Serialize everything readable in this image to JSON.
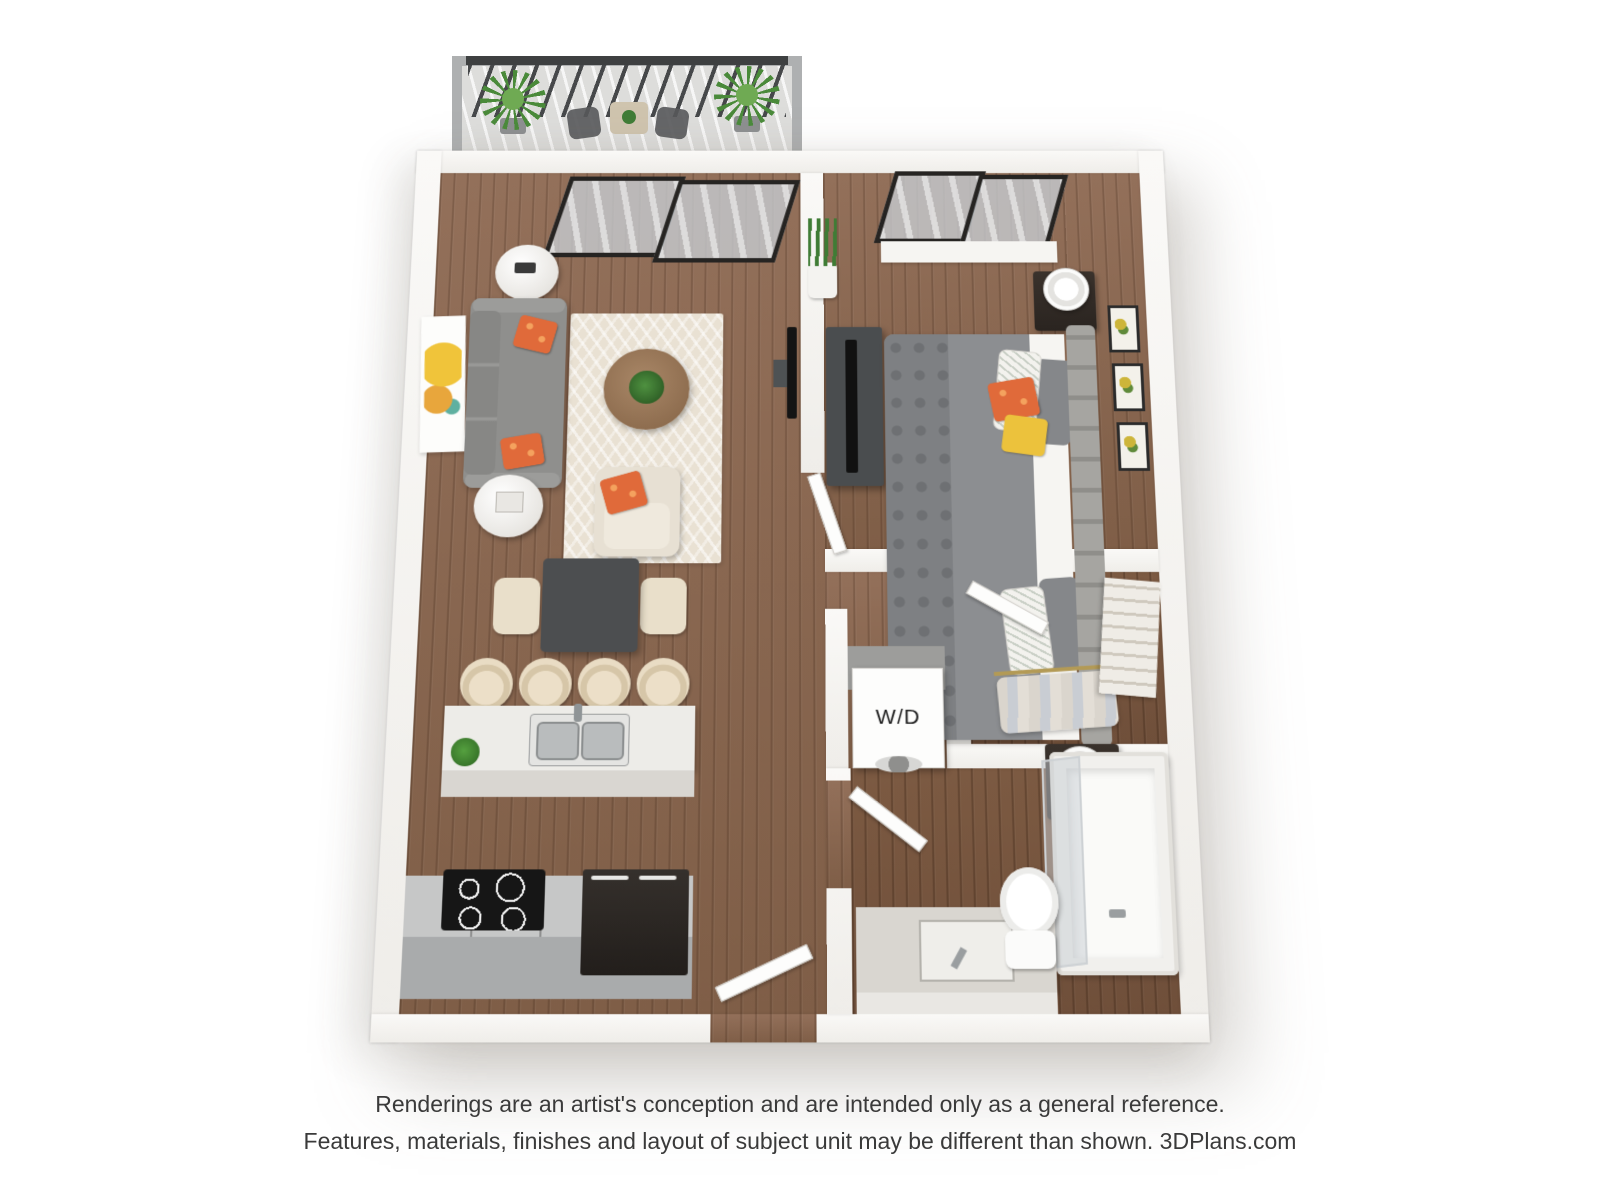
{
  "floorplan": {
    "kind": "3D one-bedroom apartment floor plan rendering",
    "labels": {
      "washer_dryer": "W/D"
    },
    "rooms": [
      "balcony",
      "living room",
      "bedroom",
      "dining area",
      "kitchen",
      "hallway",
      "walk-in closet",
      "laundry closet",
      "bathroom",
      "entry"
    ],
    "colors": {
      "background": "#ffffff",
      "wall": "#f7f6f3",
      "wood_floor": "#8a6750",
      "sofa_gray": "#8f8f8d",
      "accent_orange": "#e0673a",
      "accent_yellow": "#ecc23c",
      "rug_cream": "#e9e1d3",
      "counter_gray": "#b9bbbc",
      "appliance_black": "#1a1a1a",
      "railing_dark": "#46484a",
      "plant_green": "#4a8a3a"
    }
  },
  "footer": {
    "line1": "Renderings are an artist's conception and are intended only as a general reference.",
    "line2": "Features, materials, finishes and layout of subject unit may be different than shown. 3DPlans.com"
  }
}
